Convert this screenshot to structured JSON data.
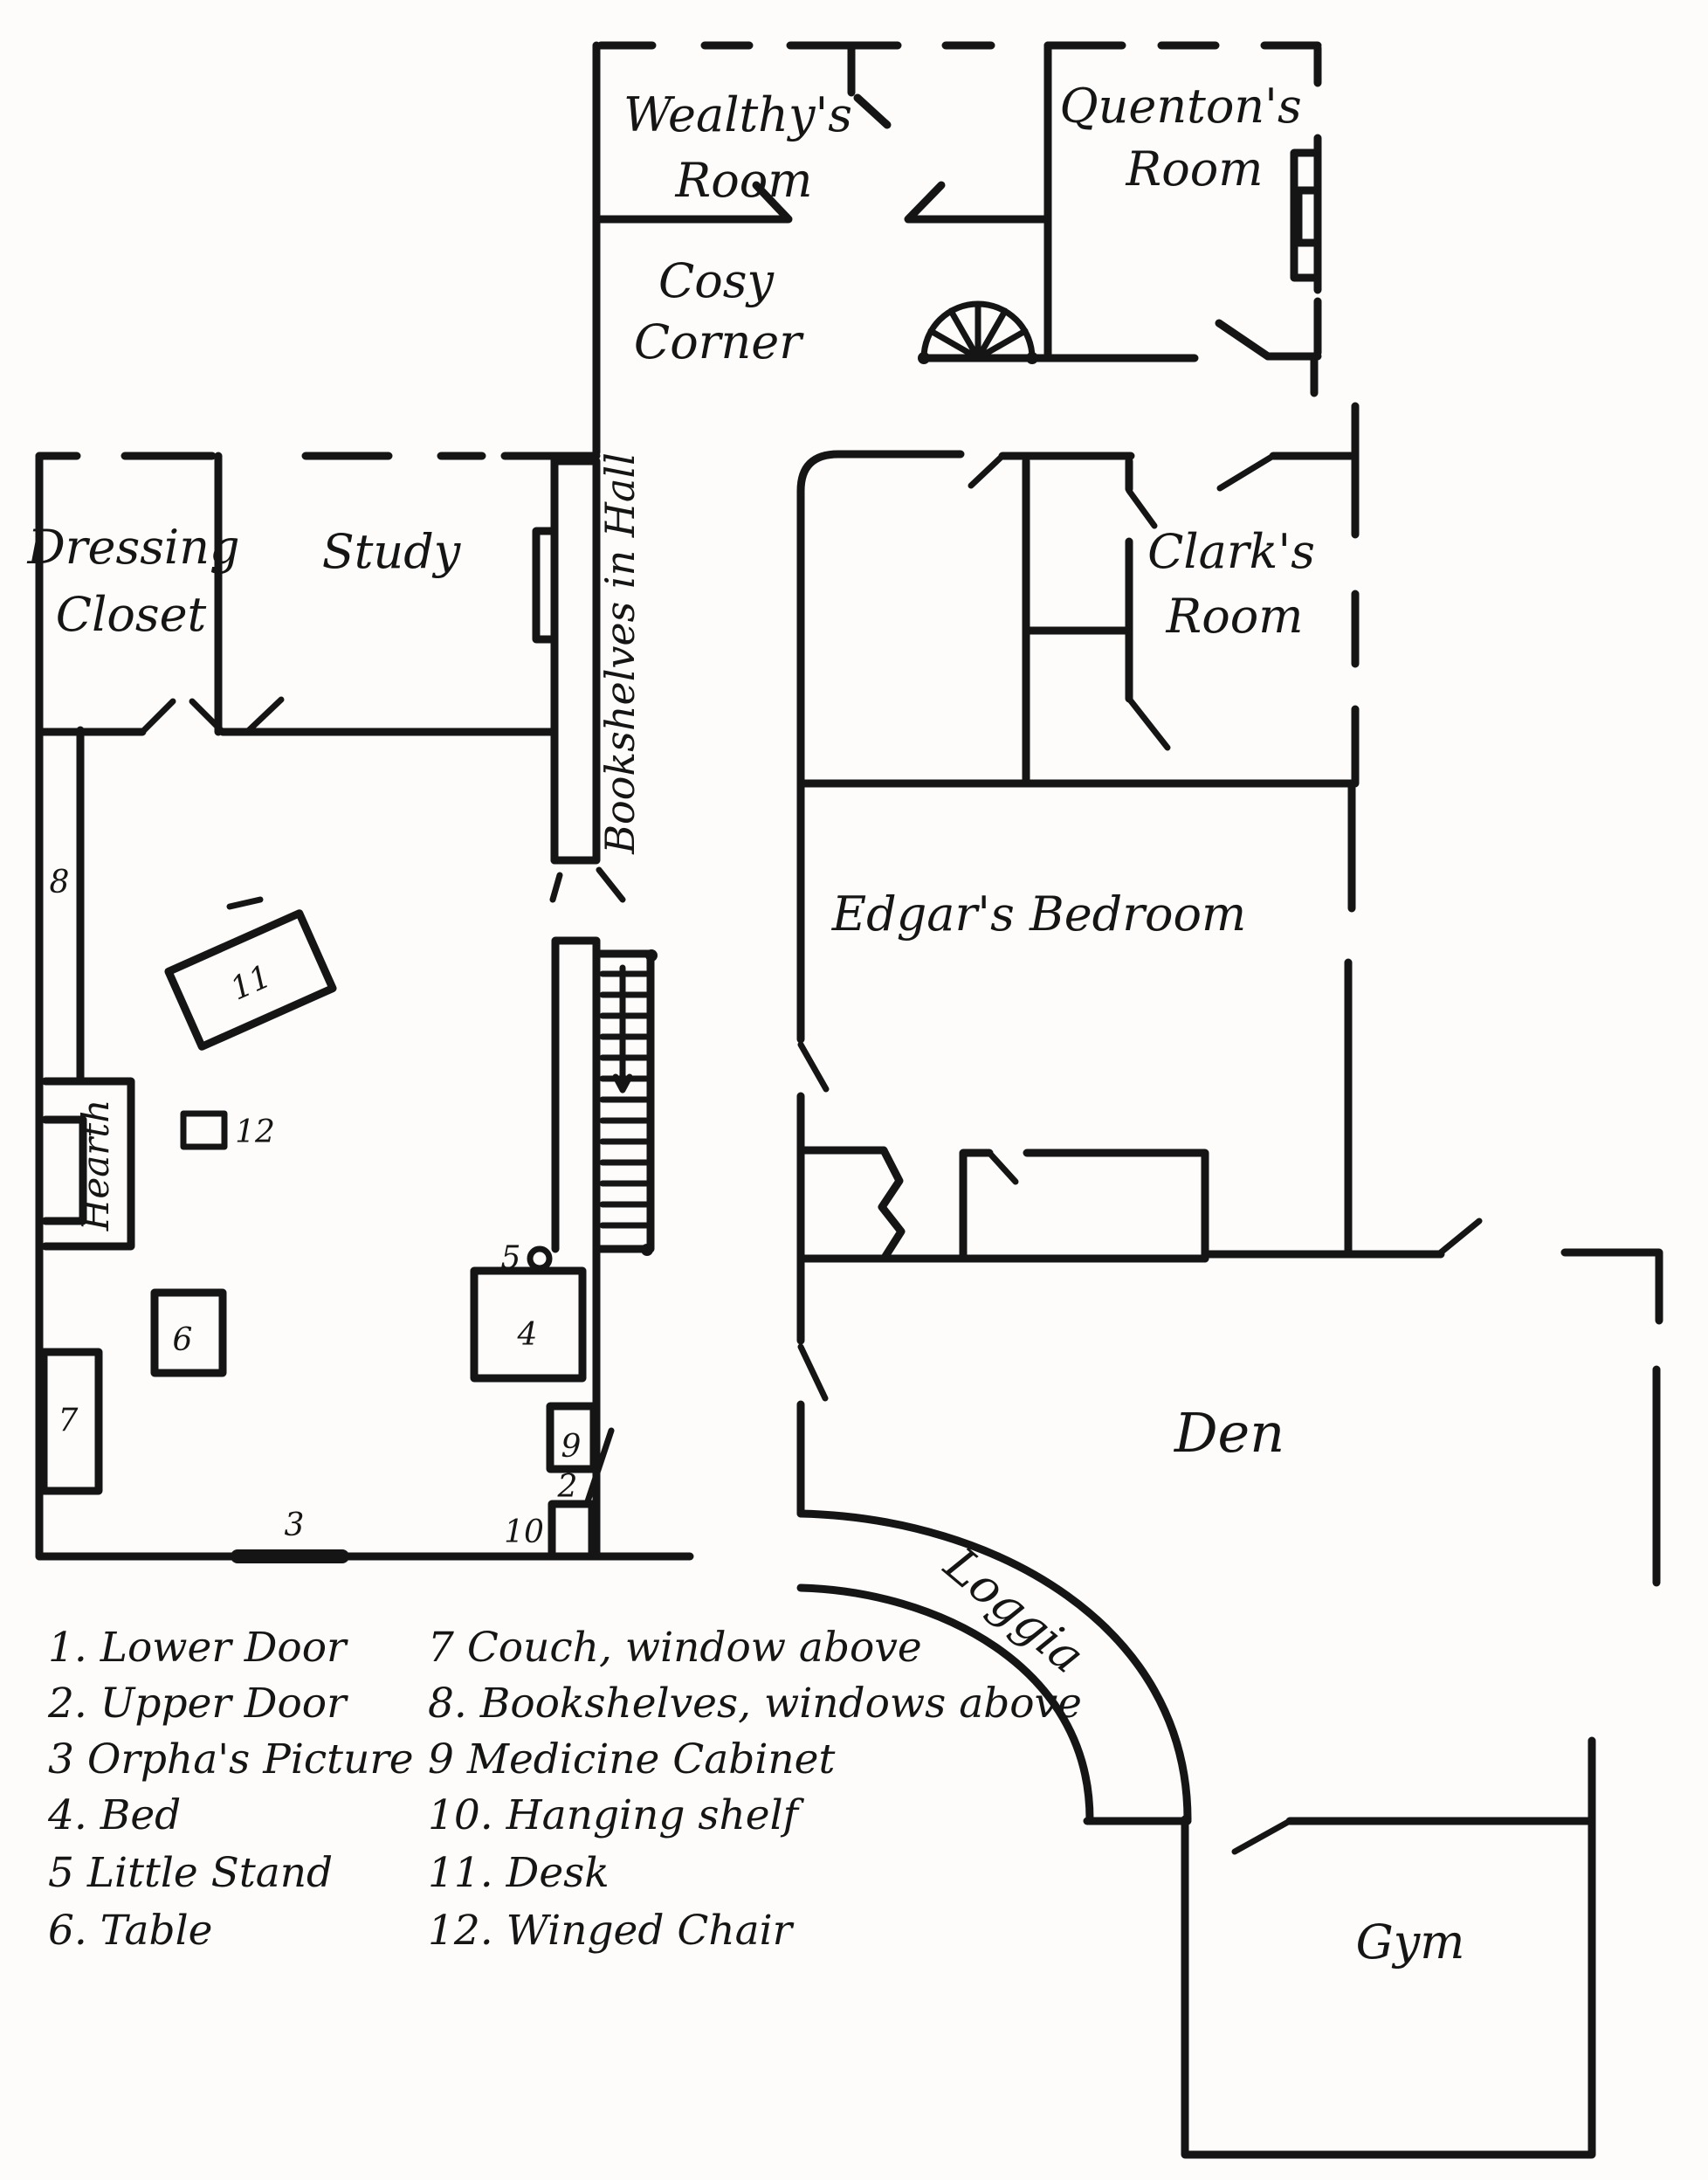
{
  "plan": {
    "rooms": {
      "wealthys": {
        "line1": "Wealthy's",
        "line2": "Room"
      },
      "quentons": {
        "line1": "Quenton's",
        "line2": "Room"
      },
      "cosy_corner": {
        "line1": "Cosy",
        "line2": "Corner"
      },
      "dressing_closet": {
        "line1": "Dressing",
        "line2": "Closet"
      },
      "study": {
        "label": "Study"
      },
      "bookshelves_hall": {
        "label": "Bookshelves in Hall"
      },
      "clarks": {
        "line1": "Clark's",
        "line2": "Room"
      },
      "edgars": {
        "label": "Edgar's Bedroom"
      },
      "den": {
        "label": "Den"
      },
      "loggia": {
        "label": "Loggia"
      },
      "gym": {
        "label": "Gym"
      },
      "hearth": {
        "label": "Hearth"
      }
    },
    "markers": {
      "2": "2",
      "3": "3",
      "4": "4",
      "5": "5",
      "6": "6",
      "7": "7",
      "8": "8",
      "9": "9",
      "10": "10",
      "11": "11",
      "12": "12"
    }
  },
  "legend": {
    "left": [
      {
        "text": "1. Lower Door"
      },
      {
        "text": "2. Upper Door"
      },
      {
        "text": "3  Orpha's Picture"
      },
      {
        "text": "4. Bed"
      },
      {
        "text": "5  Little Stand"
      },
      {
        "text": "6. Table"
      }
    ],
    "right": [
      {
        "text": "7  Couch, window above"
      },
      {
        "text": "8. Bookshelves, windows above"
      },
      {
        "text": "9  Medicine Cabinet"
      },
      {
        "text": "10. Hanging shelf"
      },
      {
        "text": "11. Desk"
      },
      {
        "text": "12. Winged Chair"
      }
    ]
  },
  "colors": {
    "ink": "#151515",
    "paper": "#fdfcfa"
  }
}
